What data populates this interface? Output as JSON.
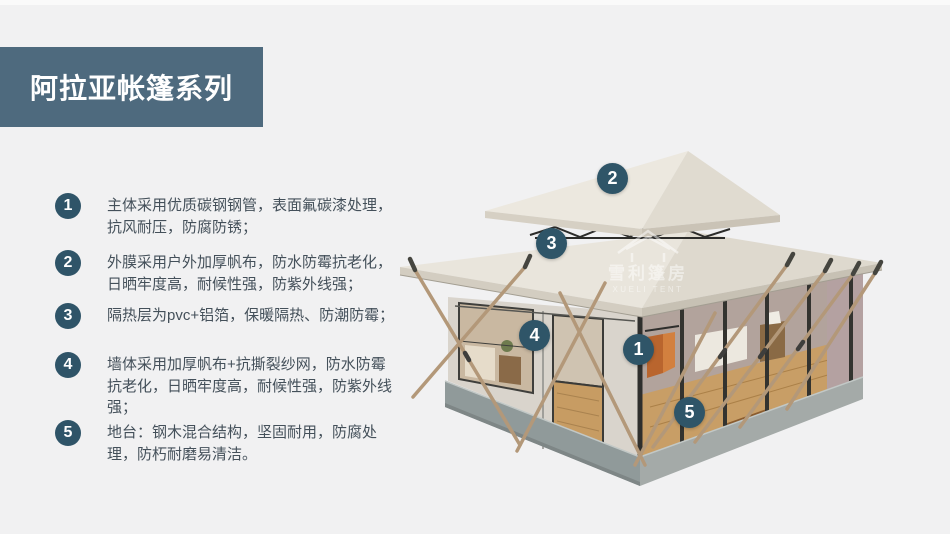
{
  "page": {
    "background": "#f1f1f2"
  },
  "title": {
    "text": "阿拉亚帐篷系列",
    "bg_color": "#4e6a7e",
    "text_color": "#ffffff"
  },
  "features": [
    {
      "num": "1",
      "text": "主体采用优质碳钢钢管，表面氟碳漆处理，抗风耐压，防腐防锈；"
    },
    {
      "num": "2",
      "text": "外膜采用户外加厚帆布，防水防霉抗老化，日晒牢度高，耐候性强，防紫外线强；"
    },
    {
      "num": "3",
      "text": "隔热层为pvc+铝箔，保暖隔热、防潮防霉；"
    },
    {
      "num": "4",
      "text": "墙体采用加厚帆布+抗撕裂纱网，防水防霉抗老化，日晒牢度高，耐候性强，防紫外线强；"
    },
    {
      "num": "5",
      "text": "地台：钢木混合结构，坚固耐用，防腐处理，防朽耐磨易清洁。"
    }
  ],
  "callouts": [
    {
      "num": "2"
    },
    {
      "num": "3"
    },
    {
      "num": "4"
    },
    {
      "num": "1"
    },
    {
      "num": "5"
    }
  ],
  "badge_color": "#2f5468",
  "watermark": {
    "cn": "雪利篷房",
    "en": "XUELI TENT"
  }
}
